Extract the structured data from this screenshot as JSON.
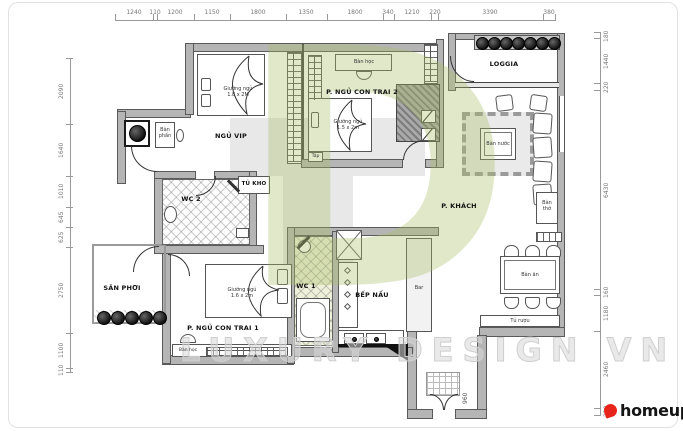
{
  "watermark": {
    "letter": "D",
    "text": "LUXURY DESIGN VN"
  },
  "brand": {
    "name": "homeup"
  },
  "colors": {
    "accent_green": "#cdd79e",
    "brand_red": "#e8231a",
    "wall_gray": "#b5b5b5"
  },
  "dimensions": {
    "top": [
      "1240",
      "110",
      "1200",
      "1150",
      "1800",
      "1350",
      "1800",
      "340",
      "1210",
      "220",
      "3390",
      "380"
    ],
    "left": [
      "2090",
      "1640",
      "1010",
      "645",
      "625",
      "2750",
      "1100",
      "110"
    ],
    "right": [
      "180",
      "1440",
      "220",
      "6430",
      "160",
      "1180",
      "2460",
      "220"
    ],
    "entry": "960"
  },
  "rooms": {
    "master": "NGỦ VIP",
    "boy2": "P. NGỦ CON TRAI 2",
    "boy1": "P. NGỦ CON TRAI 1",
    "loggia": "LOGGIA",
    "living": "P. KHÁCH",
    "kitchen": "BẾP NẤU",
    "wc1": "WC 1",
    "wc2": "WC 2",
    "storage": "TỦ KHO",
    "yard": "SÂN PHƠI"
  },
  "furniture": {
    "bed_master_name": "Giường ngủ",
    "bed_master_size": "1.8 x 2M",
    "bed_boy2_name": "Giường ngủ",
    "bed_boy2_size": "1.5 x 2m",
    "bed_boy1_name": "Giường ngủ",
    "bed_boy1_size": "1.6 x 2m",
    "desk_boy2": "Bàn học",
    "desk_boy1": "Bàn học",
    "vanity": "Bàn phấn",
    "nightstand": "Táp",
    "coffee_table": "Bàn nước",
    "altar": "Bàn thờ",
    "dining_table": "Bàn ăn",
    "wine_cabinet": "Tủ rượu",
    "bar": "Bar"
  }
}
